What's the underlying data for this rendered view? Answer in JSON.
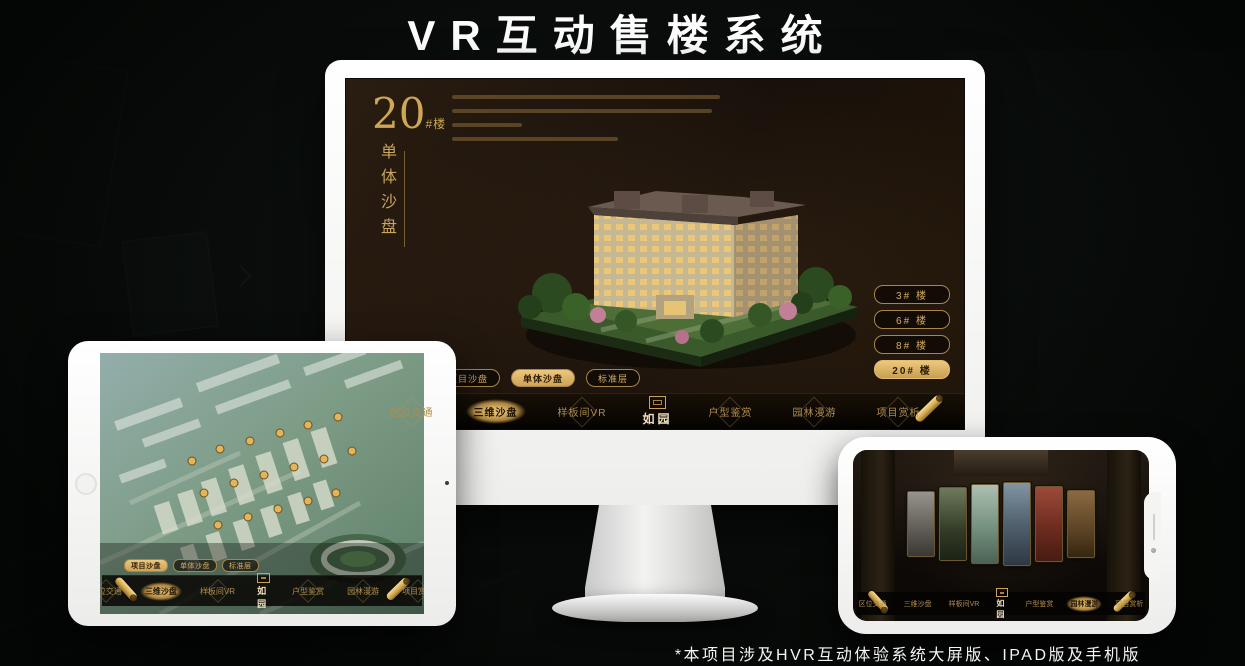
{
  "page": {
    "title": "VR互动售楼系统",
    "footnote": "*本项目涉及HVR互动体验系统大屏版、IPAD版及手机版"
  },
  "colors": {
    "accent_gold": "#c9a45c",
    "accent_gold_bright": "#ecc87f",
    "screen_background": "#18100a",
    "device_white": "#f5f5f4",
    "title_white": "#fdfdfd"
  },
  "monitor": {
    "screen": {
      "block_number": "20",
      "block_unit": "#楼",
      "subtitle_vertical": "单体沙盘",
      "building_buttons": [
        {
          "label": "3# 楼"
        },
        {
          "label": "6# 楼"
        },
        {
          "label": "8# 楼"
        },
        {
          "label": "20# 楼"
        }
      ],
      "sub_tabs": [
        {
          "label": "项目沙盘"
        },
        {
          "label": "单体沙盘"
        },
        {
          "label": "标准层"
        }
      ],
      "nav": {
        "items": [
          {
            "label": "区位交通"
          },
          {
            "label": "三维沙盘"
          },
          {
            "label": "样板间VR"
          },
          {
            "label": "户型鉴赏"
          },
          {
            "label": "园林漫游"
          },
          {
            "label": "项目赏析"
          }
        ],
        "logo": "如园"
      }
    }
  },
  "tablet": {
    "sub_tabs": [
      {
        "label": "项目沙盘"
      },
      {
        "label": "单体沙盘"
      },
      {
        "label": "标准层"
      }
    ],
    "nav": {
      "items": [
        {
          "label": "区位交通"
        },
        {
          "label": "三维沙盘"
        },
        {
          "label": "样板间VR"
        },
        {
          "label": "户型鉴赏"
        },
        {
          "label": "园林漫游"
        },
        {
          "label": "项目赏析"
        }
      ],
      "logo": "如园"
    }
  },
  "phone": {
    "nav": {
      "items": [
        {
          "label": "区位交通"
        },
        {
          "label": "三维沙盘"
        },
        {
          "label": "样板间VR"
        },
        {
          "label": "户型鉴赏"
        },
        {
          "label": "园林漫游"
        },
        {
          "label": "项目赏析"
        }
      ],
      "logo": "如园"
    }
  }
}
